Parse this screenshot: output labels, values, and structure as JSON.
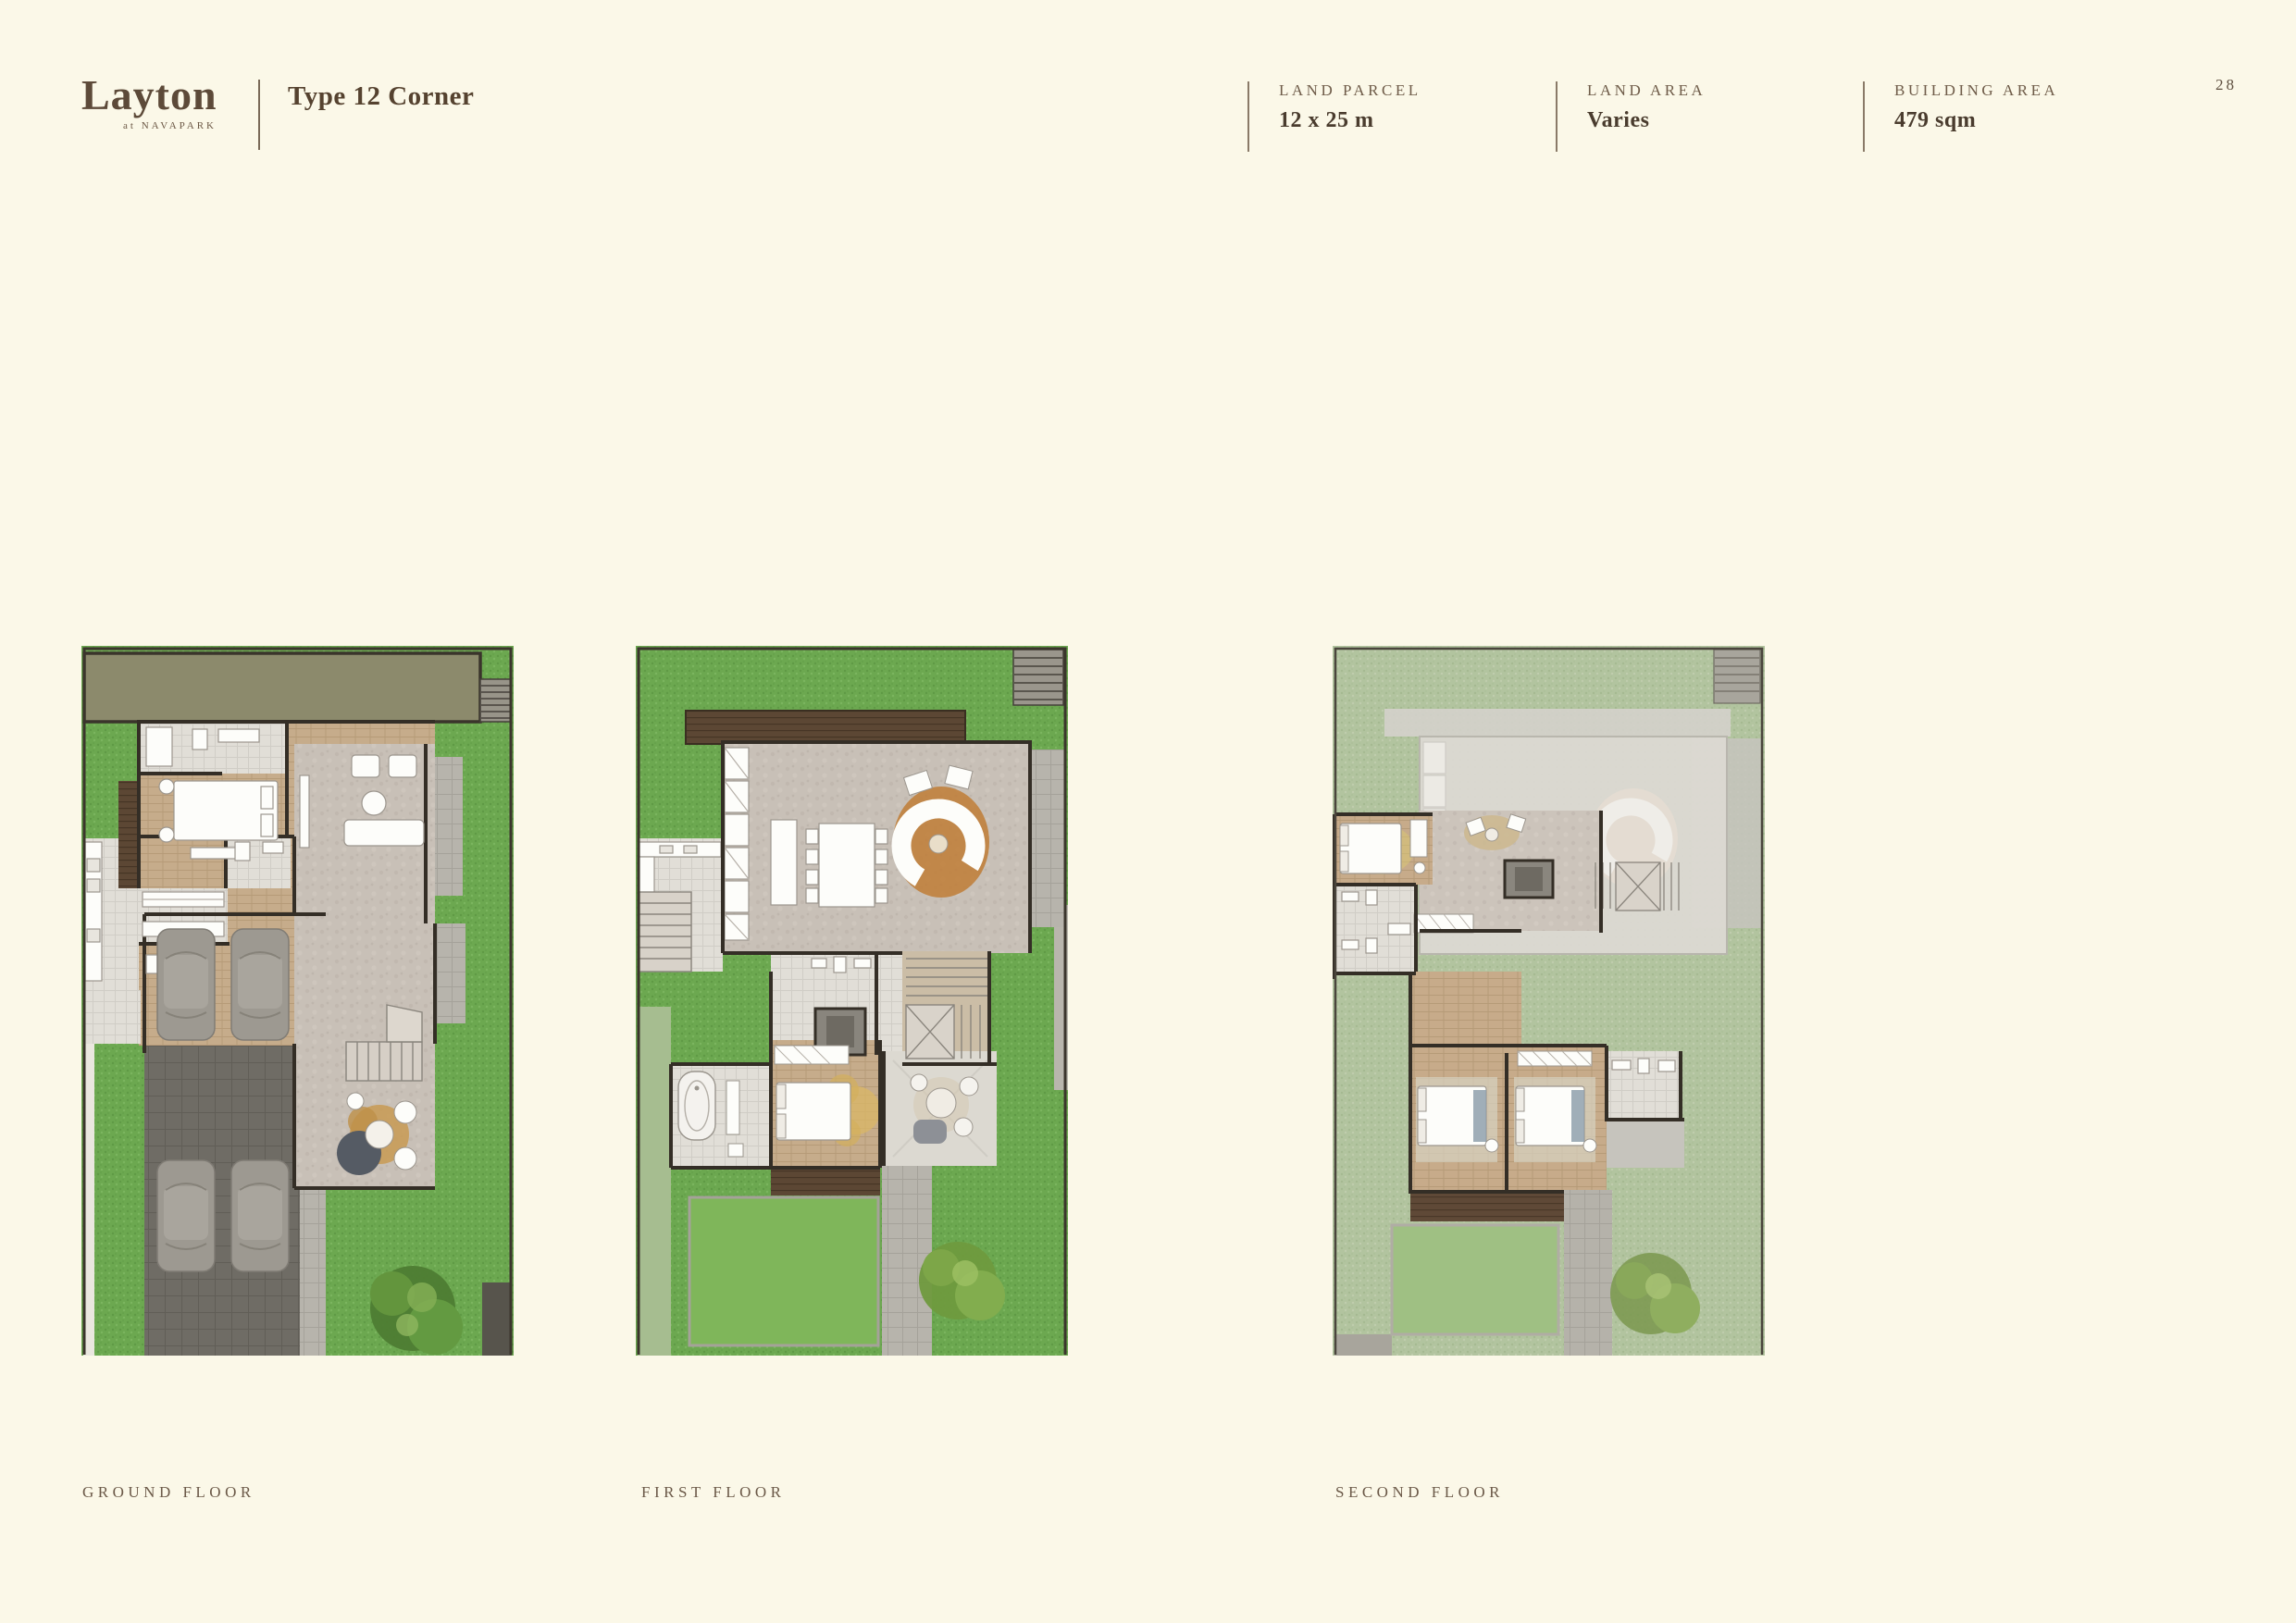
{
  "page": {
    "number": "28",
    "background": "#FBF8E8"
  },
  "header": {
    "logo": {
      "name": "Layton",
      "subtitle": "at NAVAPARK"
    },
    "title": "Type 12 Corner",
    "specs": [
      {
        "label": "LAND PARCEL",
        "value": "12 x 25 m"
      },
      {
        "label": "LAND AREA",
        "value": "Varies"
      },
      {
        "label": "BUILDING AREA",
        "value": "479 sqm"
      }
    ]
  },
  "floors": [
    {
      "id": "ground-floor",
      "label": "GROUND FLOOR"
    },
    {
      "id": "first-floor",
      "label": "FIRST FLOOR"
    },
    {
      "id": "second-floor",
      "label": "SECOND FLOOR"
    }
  ],
  "colors": {
    "accent_brown": "#5D4A39",
    "text_muted": "#6F5C49",
    "grass_green": "#6CA850",
    "grass_muted": "#B2C49F",
    "roof_olive": "#8C8A6C",
    "wall_dark": "#342E26",
    "background_cream": "#FBF8E8"
  }
}
